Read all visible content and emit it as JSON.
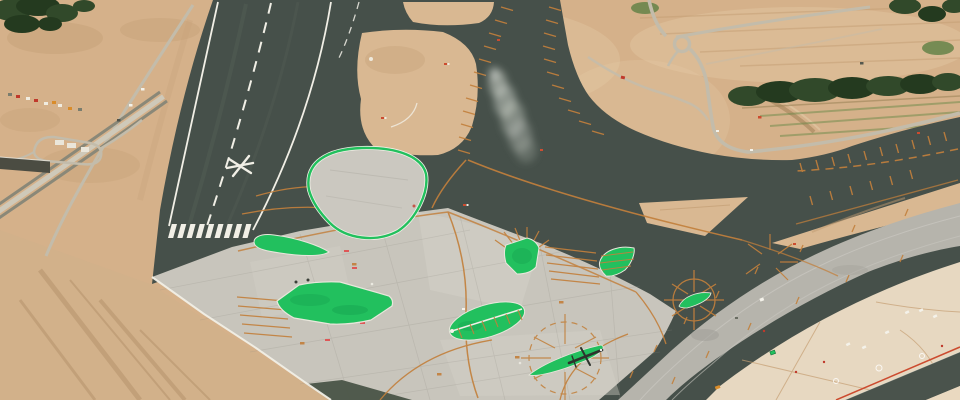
{
  "meta": {
    "title": "Aerial photograph of a new airport runway and apron under construction",
    "description": "Oblique aerial view: a dark asphalt runway with white centerline, threshold stripes and a temporary closed-runway star marker runs diagonally through bare sandy earthworks. A light concrete apron carries eight vivid green painted islands, orange taxi guidance lines, ladder markings and compass-rose patterns, with a small aircraft parked on one sliver island. A second pale runway band, a cream service apron with vehicles, access roads, a roundabout, a construction site and a tree line surround the airfield. A dust plume drifts over the parallel taxiway."
  },
  "palette": {
    "sand": "#d5b18a",
    "sand2": "#d9b892",
    "sandLight": "#e4caa6",
    "sandDark": "#c09a6f",
    "asphalt": "#46504a",
    "asphaltLane": "#555f57",
    "apron": "#c8c5bc",
    "apronLight": "#d4d1c8",
    "grayband": "#b6b4ac",
    "cream": "#e7d8c1",
    "green": "#22c05e",
    "greenDark": "#119148",
    "orange": "#c2803c",
    "white": "#f1efe6",
    "tree": "#31492a",
    "treeDark": "#243a1f",
    "road": "#c3bcab",
    "roadDark": "#8a8878",
    "red": "#c0392b",
    "redOrange": "#cc4b2f",
    "smoke": "#ccd1c9",
    "darkStrip": "#4a534c"
  },
  "scene": {
    "regions": [
      {
        "name": "main-runway",
        "desc": "dark asphalt runway, white edge lines, dashed centerline, 9 threshold stripes, white star closure marker"
      },
      {
        "name": "parallel-taxiway",
        "desc": "dark taxiway with orange ladder edge ticks joining a wide junction"
      },
      {
        "name": "right-taxiway",
        "desc": "dark taxiway entering from the right with orange centerline and rungs"
      },
      {
        "name": "concrete-apron",
        "desc": "light concrete apron with expansion joints, orange guidance lines and red paint marks"
      },
      {
        "name": "outlined-island",
        "desc": "concrete teardrop island with bright green painted border"
      },
      {
        "name": "green-islands",
        "desc": "seven solid bright-green painted islands of varied shapes",
        "count": 7
      },
      {
        "name": "second-runway-band",
        "desc": "pale gray runway/taxiway band crossing the lower right"
      },
      {
        "name": "cream-service-apron",
        "desc": "cream apron with maintenance vehicles and faint markings"
      },
      {
        "name": "aircraft",
        "desc": "small dark aircraft parked on green sliver island inside compass-rose markings"
      },
      {
        "name": "smoke-plume",
        "desc": "gray dust plume drifting across the taxiway"
      },
      {
        "name": "access-roads",
        "desc": "light roads, dual carriageway, roundabout, parking loop and buildings"
      },
      {
        "name": "construction-site",
        "desc": "row of colorful construction vehicles on bare earth"
      },
      {
        "name": "vegetation",
        "desc": "tree clusters top-left and a long tree line top-right"
      }
    ],
    "counts": {
      "threshold_stripes": 9,
      "green_islands": 8,
      "compass_roses": 2
    }
  }
}
